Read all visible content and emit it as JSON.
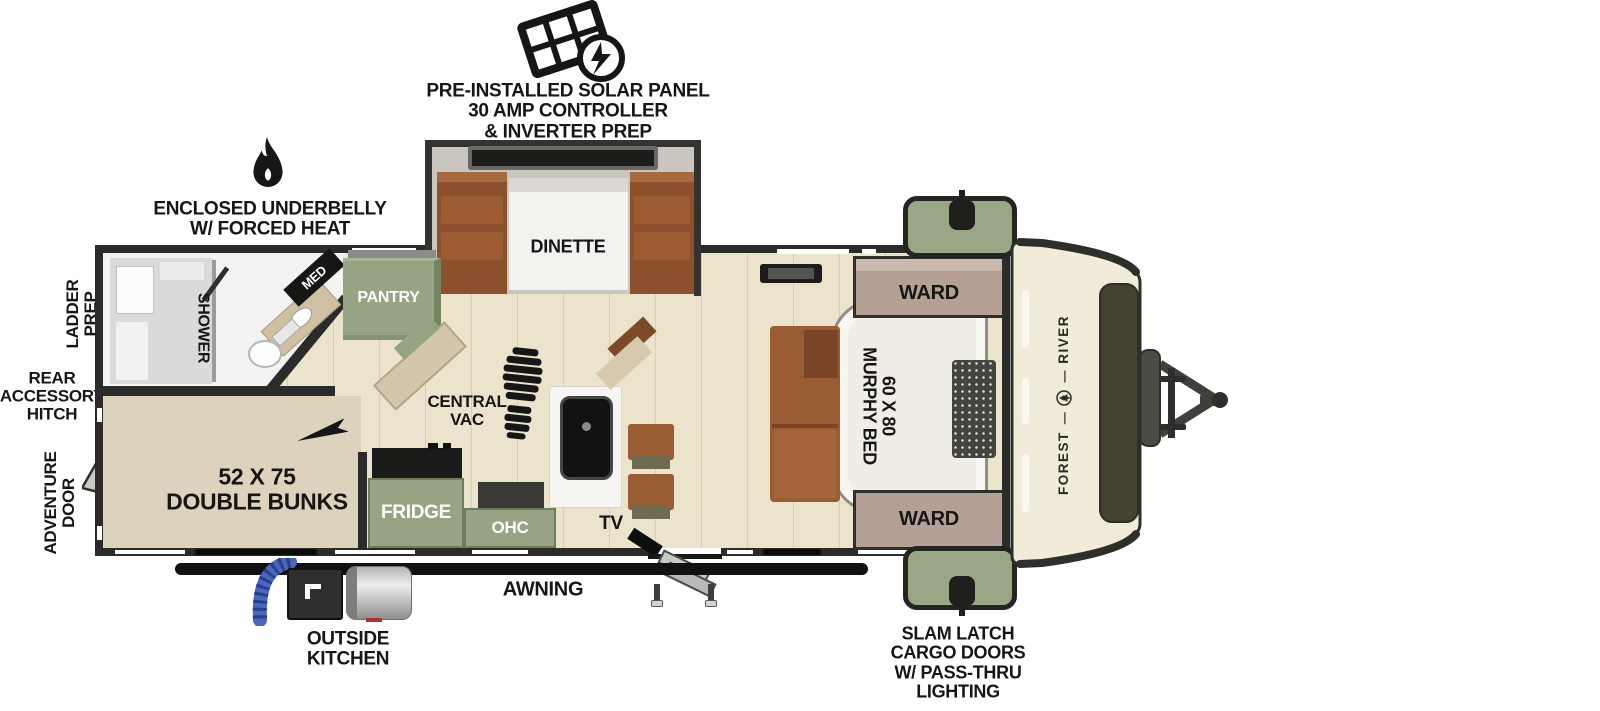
{
  "callouts": {
    "solar": {
      "line1": "PRE-INSTALLED SOLAR PANEL",
      "line2": "30 AMP CONTROLLER",
      "line3": "& INVERTER PREP"
    },
    "underbelly": {
      "line1": "ENCLOSED UNDERBELLY",
      "line2": "W/ FORCED HEAT"
    },
    "ladder_prep": {
      "line1": "LADDER",
      "line2": "PREP"
    },
    "rear_hitch": {
      "line1": "REAR",
      "line2": "ACCESSORY",
      "line3": "HITCH"
    },
    "adventure_door": {
      "line1": "ADVENTURE",
      "line2": "DOOR"
    },
    "outside_kitchen": {
      "line1": "OUTSIDE",
      "line2": "KITCHEN"
    },
    "awning": "AWNING",
    "slam_latch": {
      "line1": "SLAM LATCH",
      "line2": "CARGO DOORS",
      "line3": "W/ PASS-THRU",
      "line4": "LIGHTING"
    }
  },
  "rooms": {
    "dinette": "DINETTE",
    "med": "MED",
    "pantry": "PANTRY",
    "shower": "SHOWER",
    "ward_top": "WARD",
    "ward_bottom": "WARD",
    "murphy_bed": {
      "line1": "60 X 80",
      "line2": "MURPHY BED"
    },
    "bunks": {
      "line1": "52 X 75",
      "line2": "DOUBLE BUNKS"
    },
    "central_vac": {
      "line1": "CENTRAL",
      "line2": "VAC"
    },
    "fridge": "FRIDGE",
    "ohc": "OHC",
    "tv": "TV"
  },
  "brand": {
    "word1": "FOREST",
    "word2": "RIVER",
    "separator": "—"
  },
  "colors": {
    "cabinet_green": "#96a483",
    "ward_mauve": "#b5a096",
    "wood_floor": "#ece3cd",
    "bunk_floor": "#ddd3bd",
    "wall_dark": "#2b2b29",
    "furniture_brown": "#9a5c33",
    "cap_cream": "#f1ecda",
    "cap_window_olive": "#45422f",
    "hose_blue": "#4a66bd"
  }
}
